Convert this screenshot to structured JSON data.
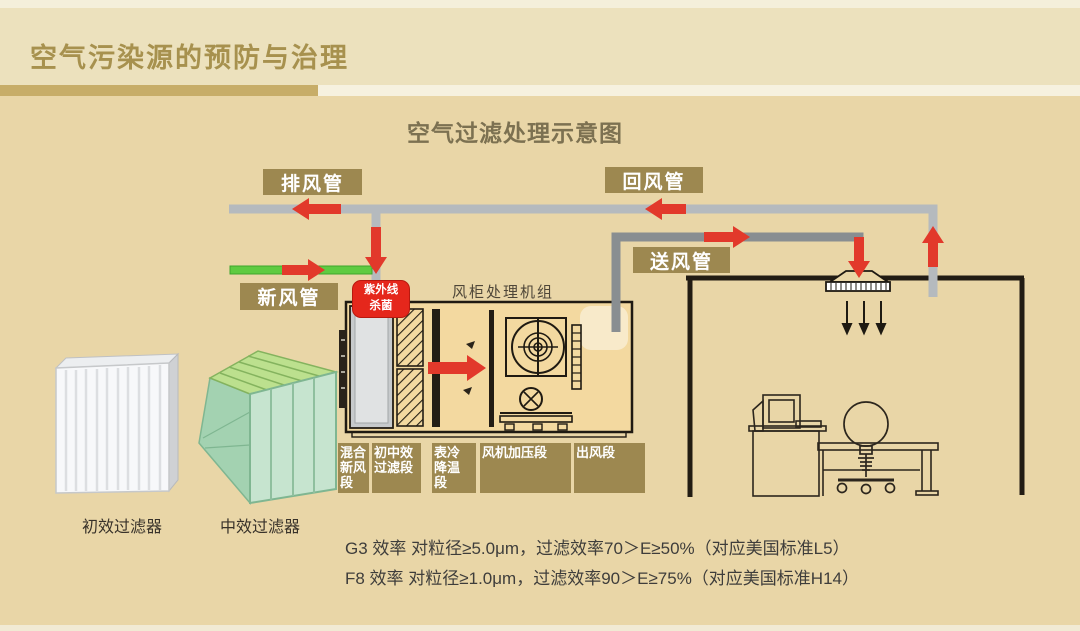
{
  "slide": {
    "title": "空气污染源的预防与治理",
    "subtitle": "空气过滤处理示意图"
  },
  "labels": {
    "exhaust_duct": "排风管",
    "return_duct": "回风管",
    "fresh_duct": "新风管",
    "supply_duct": "送风管",
    "uv": "紫外线\n杀菌",
    "ahu_title": "风柜处理机组"
  },
  "ahu_sections": [
    "混合\n新风\n段",
    "初中效\n过滤段",
    "表冷\n降温\n段",
    "风机加压段",
    "出风段"
  ],
  "filter_captions": [
    "初效过滤器",
    "中效过滤器"
  ],
  "notes": [
    "G3 效率 对粒径≥5.0μm，过滤效率70＞E≥50%（对应美国标准L5）",
    "F8 效率 对粒径≥1.0μm，过滤效率90＞E≥75%（对应美国标准H14）"
  ],
  "colors": {
    "background": "#e9d6a7",
    "title_gold": "#a7914e",
    "label_gold": "#9d8850",
    "arrow_red": "#e2392b",
    "duct_gray": "#b5babe",
    "supply_duct_gray": "#898e91",
    "fresh_air_green": "#5ecb41",
    "uv_red": "#e5271c"
  }
}
